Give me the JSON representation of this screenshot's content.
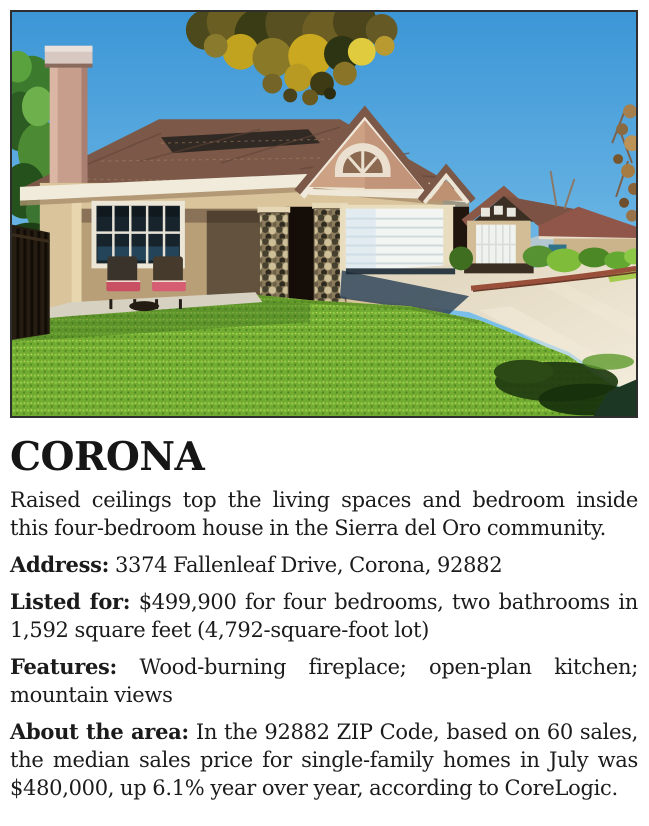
{
  "article": {
    "headline": "CORONA",
    "intro": "Raised ceilings top the living spaces and bedroom inside this four-bedroom house in the Sierra del Oro community.",
    "details": [
      {
        "label": "Address:",
        "text": "3374 Fallenleaf Drive, Corona, 92882"
      },
      {
        "label": "Listed for:",
        "text": "$499,900 for four bedrooms, two bathrooms in 1,592 square feet (4,792-square-foot lot)"
      },
      {
        "label": "Features:",
        "text": "Wood-burning fireplace; open-plan kitchen; mountain views"
      },
      {
        "label": "About the area:",
        "text": "In the 92882 ZIP Code, based on 60 sales, the median sales price for single-family homes in July was $480,000, up 6.1% year over year, according to CoreLogic."
      }
    ]
  },
  "photo": {
    "description": "Single-story cream stucco house with brown shingle roof, tall chimney, stone entry pillars, white two-car garage, green front lawn, driveway and neighboring homes under a blue sky",
    "colors": {
      "sky": "#4aa0dc",
      "roof": "#7b5847",
      "stucco": "#d9c49c",
      "stone": "#8d7c5c",
      "lawn": "#72ab31",
      "driveway": "#e9deca",
      "curb": "#9a4f3a",
      "garage_door": "#f3f5f3"
    }
  }
}
